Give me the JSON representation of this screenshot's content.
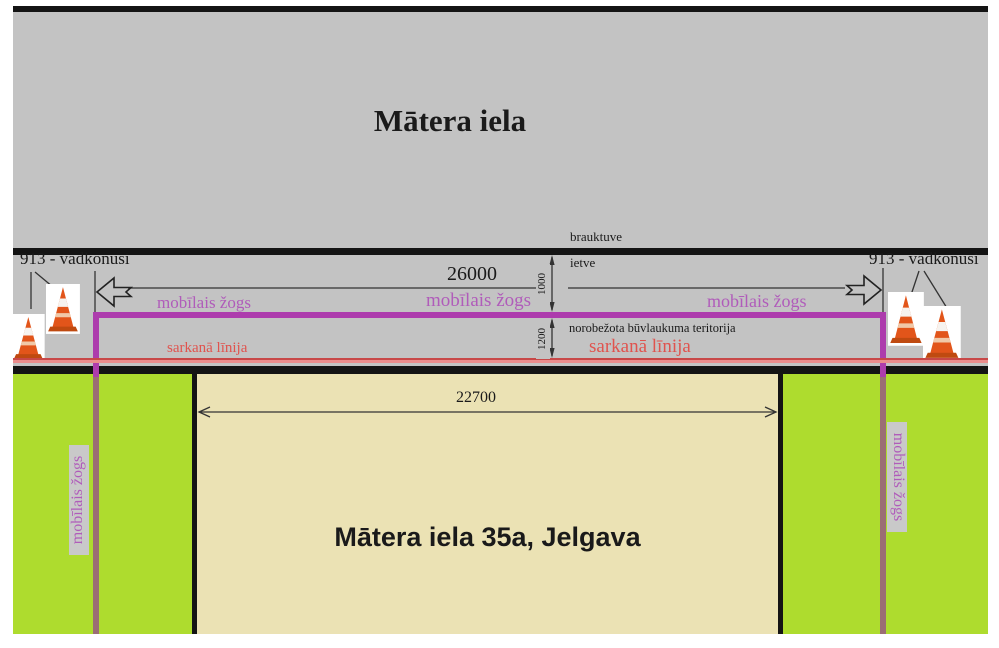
{
  "labels": {
    "street_title": "Mātera iela",
    "building": "Mātera iela 35a, Jelgava",
    "roadway": "brauktuve",
    "sidewalk": "ietve",
    "restricted_zone": "norobežota būvlaukuma teritorija",
    "red_line": "sarkanā līnija",
    "mobile_fence": "mobīlais žogs",
    "cones": "913 - vadkonusi"
  },
  "dimensions": {
    "fence_length": "26000",
    "sidewalk_width": "1000",
    "zone_width": "1200",
    "building_width": "22700"
  },
  "colors": {
    "street_gray": "#c3c3c3",
    "grass_green": "#aedc2e",
    "building_beige": "#ebe2b4",
    "fence_magenta": "#ad3cad",
    "fence_lower_mauve": "#9b6e74",
    "fence_text_purple": "#b05cba",
    "red_line": "#d95454",
    "red_text": "#e0534e",
    "cone_orange": "#e2551a",
    "bar_black": "#141414"
  }
}
